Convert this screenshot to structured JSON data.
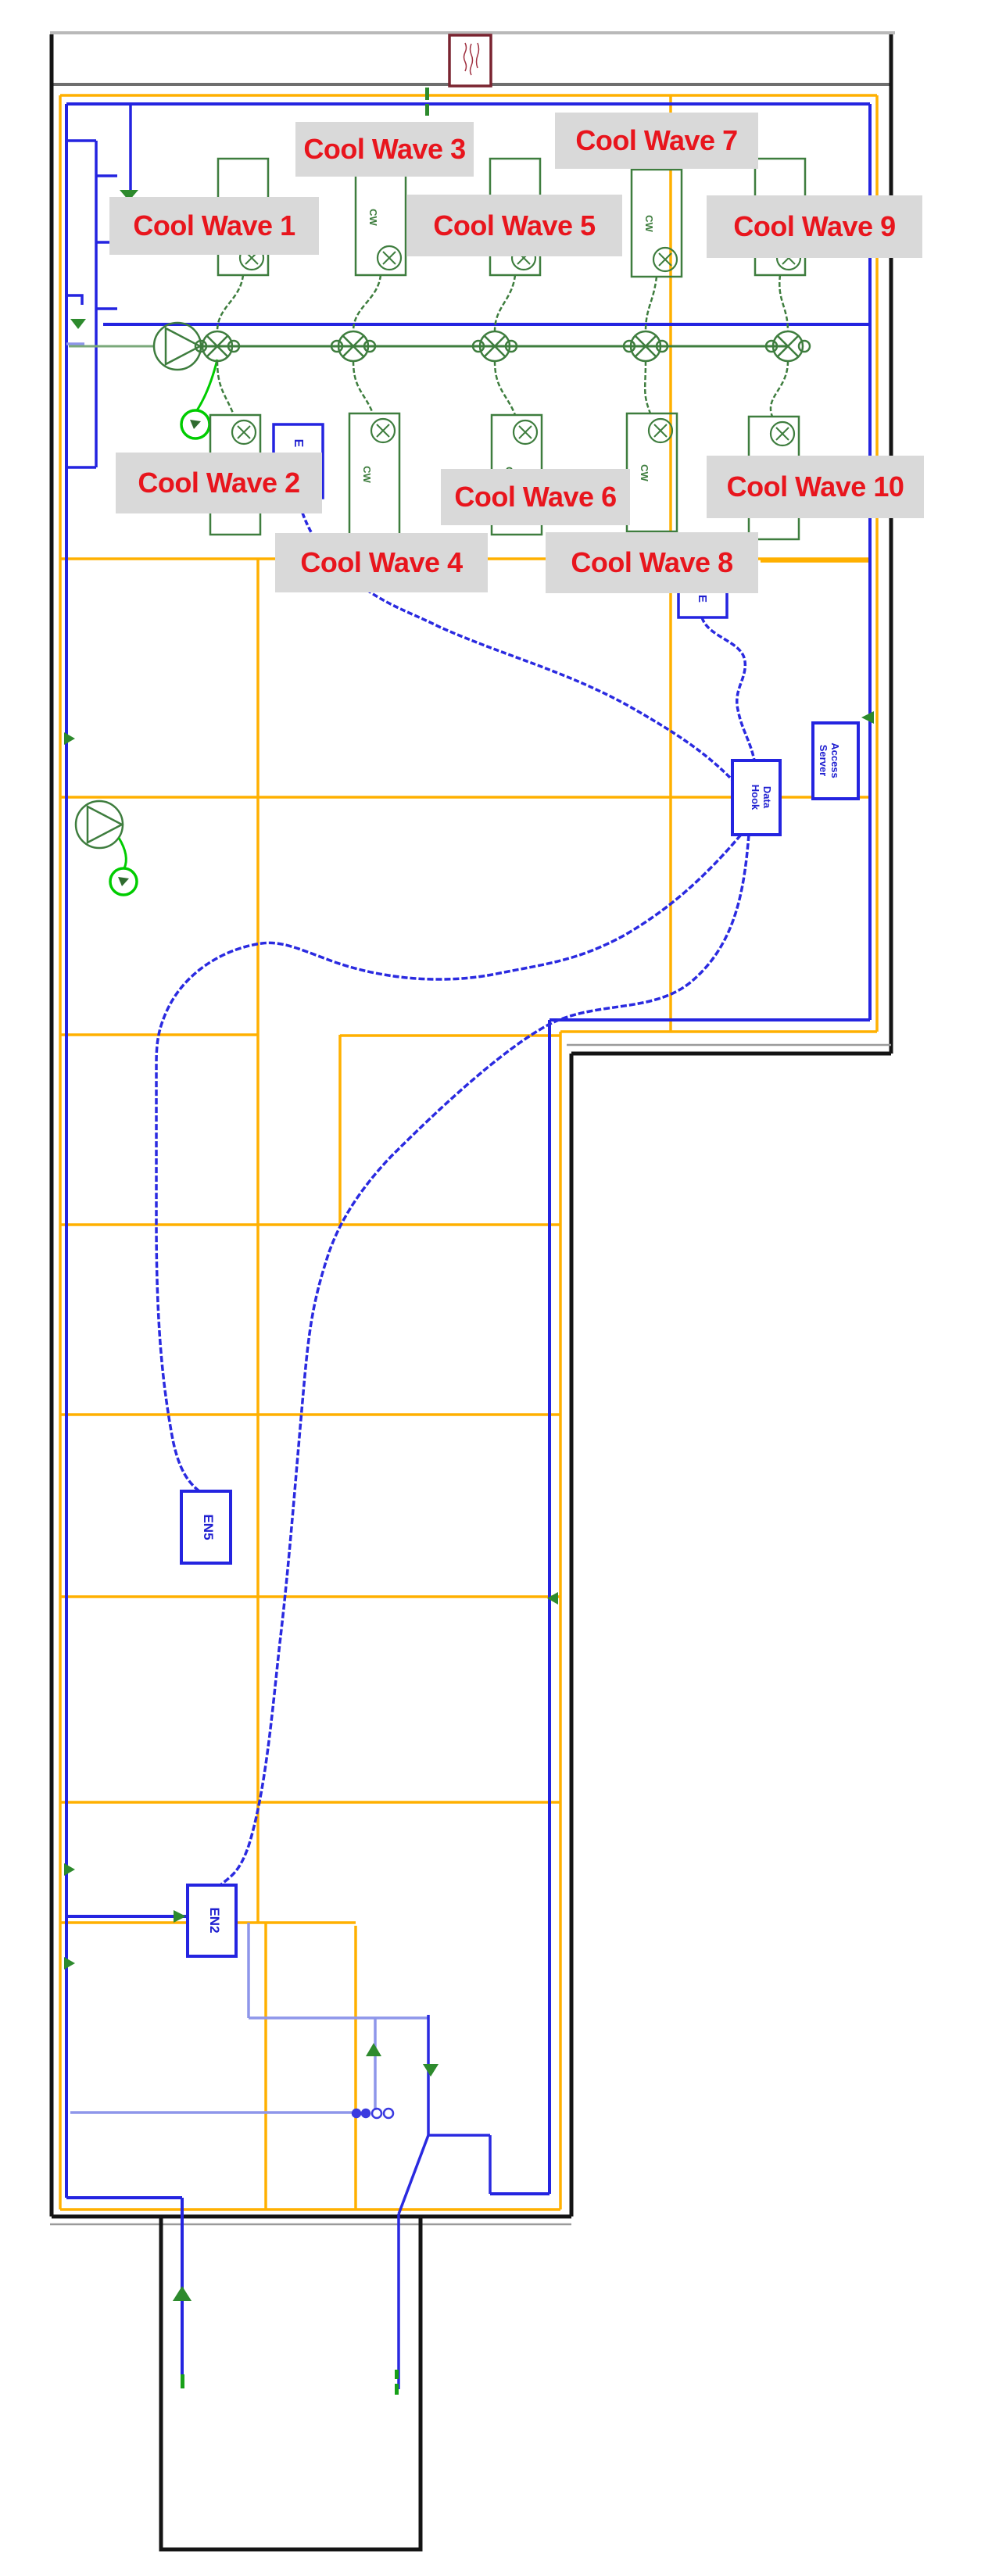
{
  "diagram": {
    "type": "hvac-floor-plan",
    "cool_wave_labels": [
      "Cool Wave 1",
      "Cool Wave 2",
      "Cool Wave 3",
      "Cool Wave 4",
      "Cool Wave 5",
      "Cool Wave 6",
      "Cool Wave 7",
      "Cool Wave 8",
      "Cool Wave 9",
      "Cool Wave 10"
    ],
    "unit_box_label": "CW",
    "boxes": {
      "en5": "EN5",
      "en2": "EN2",
      "e1": "E",
      "e2": "E",
      "data_hook_line1": "Data",
      "data_hook_line2": "Hook",
      "server_line1": "Access",
      "server_line2": "Server"
    },
    "colors": {
      "label_bg": "#d9d9d9",
      "label_text": "#e8151d",
      "wall_black": "#141414",
      "wall_gray_light": "#b9b9b9",
      "wall_gray_dark": "#6e6e6e",
      "partition_yellow": "#ffb000",
      "cable_blue": "#2424e0",
      "cable_light_blue": "#8e96ea",
      "pipe_green": "#3e7d3e",
      "pipe_green_light": "#7aa87a",
      "bright_green": "#00cc00",
      "arrow_green": "#2d8a2d",
      "tag_maroon": "#7a2430"
    }
  }
}
